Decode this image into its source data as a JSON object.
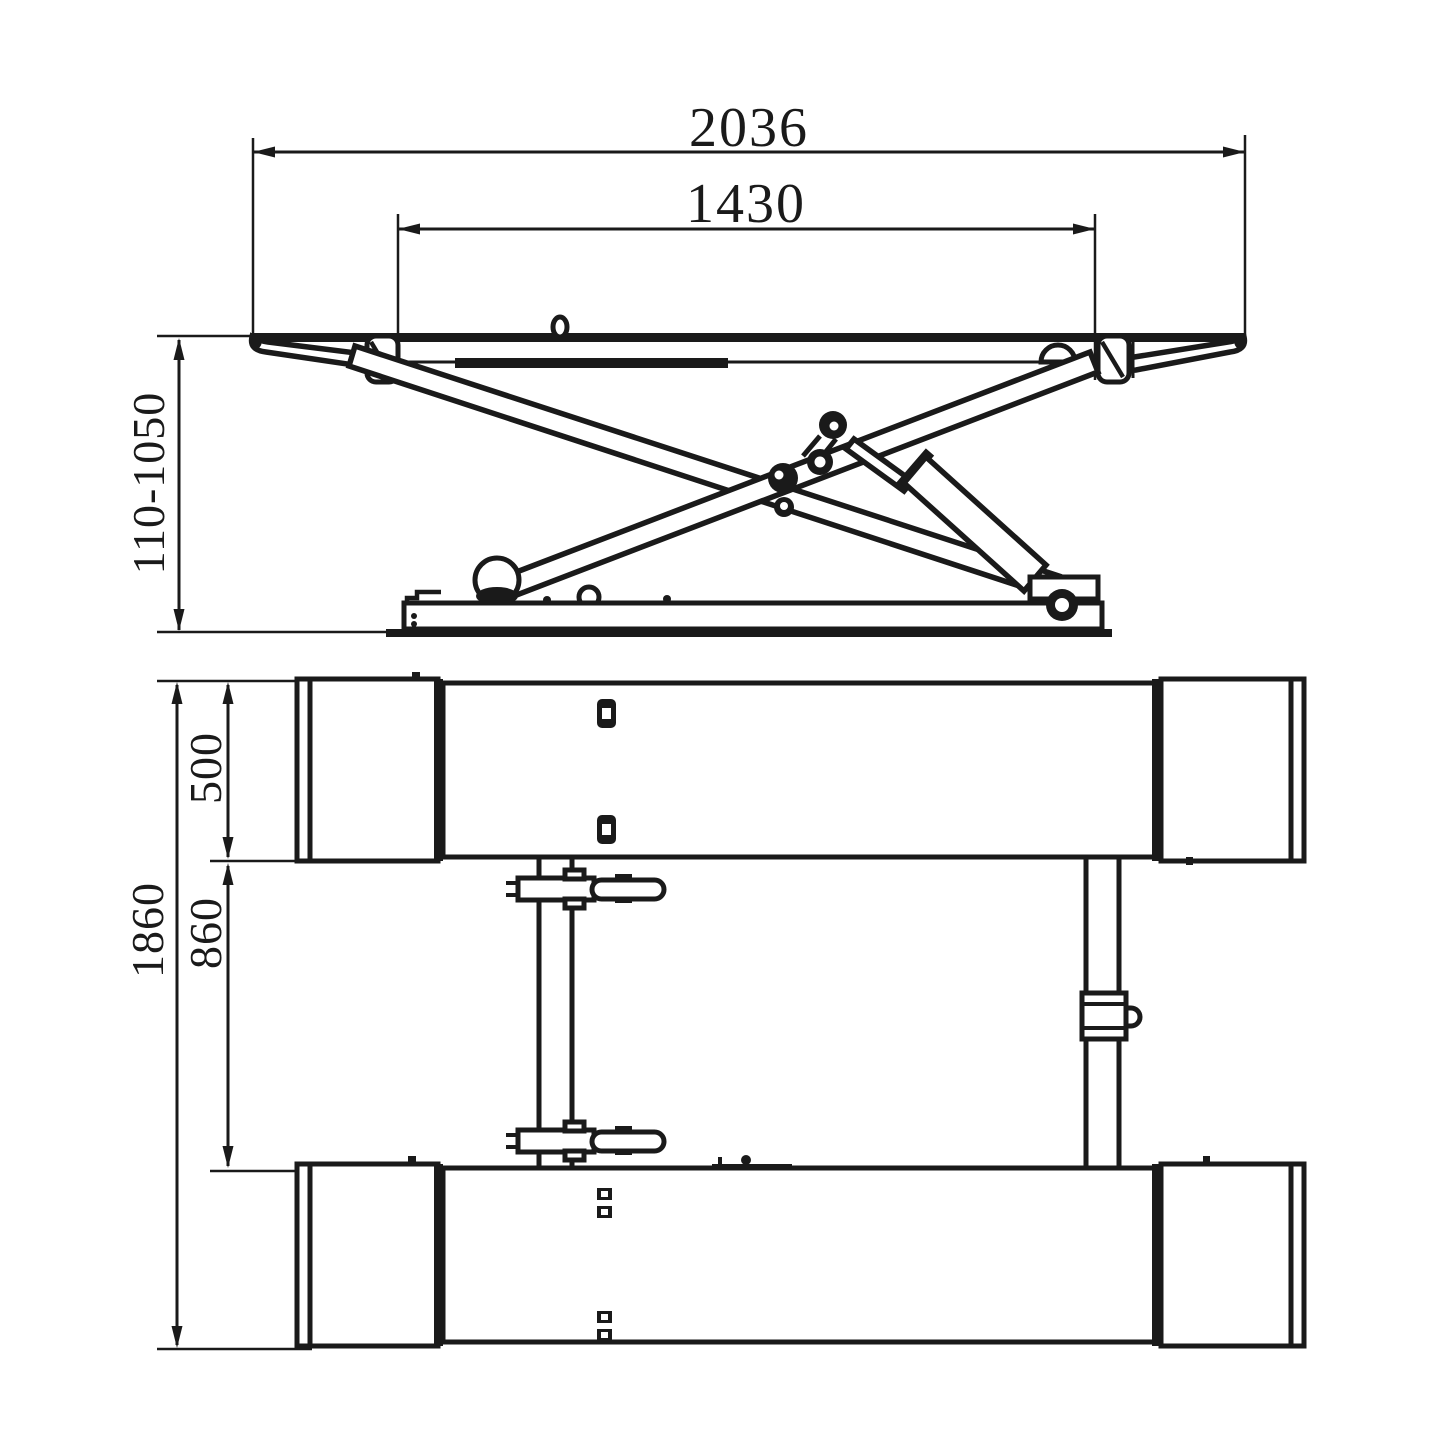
{
  "drawing": {
    "description": "Scissor lift technical drawing, two orthographic views",
    "colors": {
      "line": "#1a1a1a",
      "background": "#ffffff"
    },
    "side_view": {
      "dims": {
        "overall_length": "2036",
        "platform_length": "1430",
        "height_range": "110-1050"
      }
    },
    "plan_view": {
      "dims": {
        "platform_width": "500",
        "inner_gap": "860",
        "overall_width": "1860"
      }
    }
  }
}
